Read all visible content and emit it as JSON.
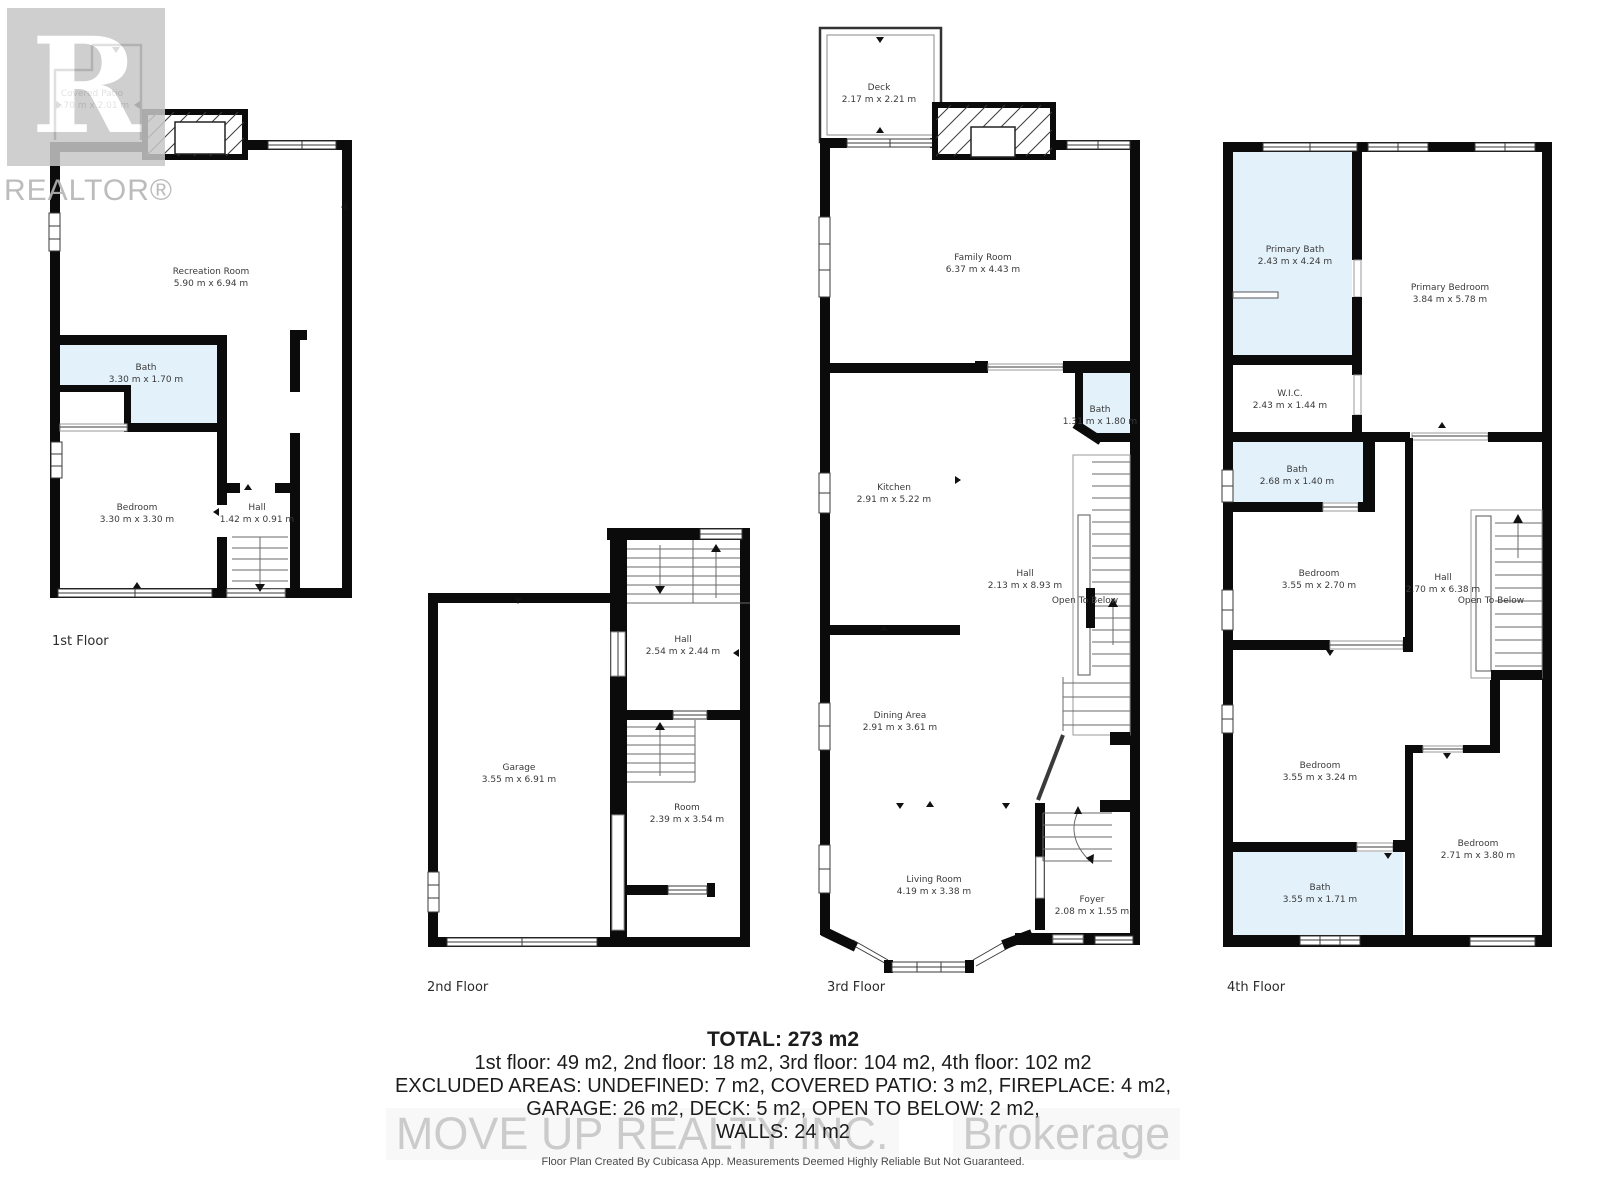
{
  "watermarks": {
    "realtor_logo_letter": "R",
    "realtor_wordmark": "REALTOR®",
    "brokerage_left": "MOVE UP REALTY INC.",
    "brokerage_right": "Brokerage"
  },
  "floors": [
    {
      "label": "1st Floor",
      "rooms": [
        {
          "name": "Covered Patio",
          "dims": "1.70 m x 2.01 m"
        },
        {
          "name": "Recreation Room",
          "dims": "5.90 m x 6.94 m"
        },
        {
          "name": "Bath",
          "dims": "3.30 m x 1.70 m"
        },
        {
          "name": "Bedroom",
          "dims": "3.30 m x 3.30 m"
        },
        {
          "name": "Hall",
          "dims": "1.42 m x 0.91 m"
        }
      ]
    },
    {
      "label": "2nd Floor",
      "rooms": [
        {
          "name": "Garage",
          "dims": "3.55 m x 6.91 m"
        },
        {
          "name": "Hall",
          "dims": "2.54 m x 2.44 m"
        },
        {
          "name": "Room",
          "dims": "2.39 m x 3.54 m"
        }
      ]
    },
    {
      "label": "3rd Floor",
      "open_to_below": "Open To Below",
      "rooms": [
        {
          "name": "Deck",
          "dims": "2.17 m x 2.21 m"
        },
        {
          "name": "Family Room",
          "dims": "6.37 m x 4.43 m"
        },
        {
          "name": "Bath",
          "dims": "1.31 m x 1.80 m"
        },
        {
          "name": "Kitchen",
          "dims": "2.91 m x 5.22 m"
        },
        {
          "name": "Hall",
          "dims": "2.13 m x 8.93 m"
        },
        {
          "name": "Dining Area",
          "dims": "2.91 m x 3.61 m"
        },
        {
          "name": "Living Room",
          "dims": "4.19 m x 3.38 m"
        },
        {
          "name": "Foyer",
          "dims": "2.08 m x 1.55 m"
        }
      ]
    },
    {
      "label": "4th Floor",
      "open_to_below": "Open To Below",
      "rooms": [
        {
          "name": "Primary Bath",
          "dims": "2.43 m x 4.24 m"
        },
        {
          "name": "Primary Bedroom",
          "dims": "3.84 m x 5.78 m"
        },
        {
          "name": "W.I.C.",
          "dims": "2.43 m x 1.44 m"
        },
        {
          "name": "Bath",
          "dims": "2.68 m x 1.40 m"
        },
        {
          "name": "Bedroom",
          "dims": "3.55 m x 2.70 m"
        },
        {
          "name": "Hall",
          "dims": "2.70 m x 6.38 m"
        },
        {
          "name": "Bedroom",
          "dims": "3.55 m x 3.24 m"
        },
        {
          "name": "Bedroom",
          "dims": "2.71 m x 3.80 m"
        },
        {
          "name": "Bath",
          "dims": "3.55 m x 1.71 m"
        }
      ]
    }
  ],
  "summary": {
    "total": "TOTAL: 273 m2",
    "floor_areas": "1st floor: 49 m2, 2nd floor: 18 m2, 3rd floor: 104 m2, 4th floor: 102 m2",
    "excluded_1": "EXCLUDED AREAS: UNDEFINED: 7 m2, COVERED PATIO: 3 m2, FIREPLACE: 4 m2,",
    "excluded_2": "GARAGE: 26 m2, DECK: 5 m2, OPEN TO BELOW: 2 m2,",
    "walls": "WALLS: 24 m2"
  },
  "footer": {
    "disclaimer": "Floor Plan Created By Cubicasa App. Measurements Deemed Highly Reliable But Not Guaranteed."
  },
  "colors": {
    "bath_fill": "#e2f1fa",
    "wall": "#0b0b0b",
    "watermark_gray": "#c7c7c7"
  }
}
